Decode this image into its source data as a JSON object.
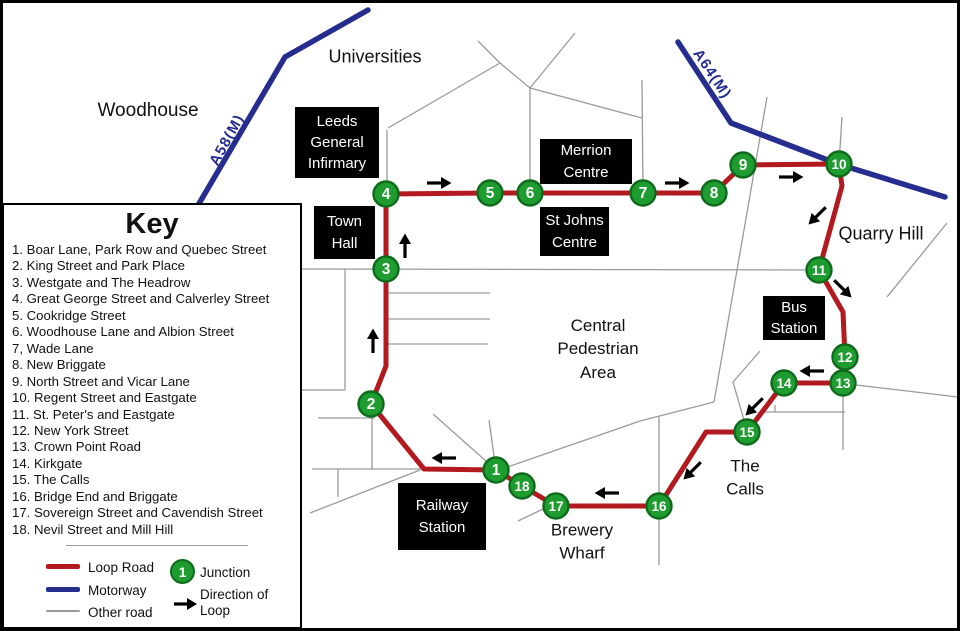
{
  "colors": {
    "loop_road": "#B21A20",
    "motorway": "#252D8F",
    "other_road": "#9A9A9A",
    "junction_fill": "#1E9C30",
    "junction_ring": "#0E6B1C",
    "junction_text": "#FFFFFF",
    "arrow": "#000000",
    "box_bg": "#000000",
    "box_text": "#FFFFFF"
  },
  "key_panel": {
    "title": "Key",
    "items": [
      "1. Boar Lane, Park Row and Quebec Street",
      "2. King Street and Park Place",
      "3. Westgate and The Headrow",
      "4. Great George Street and Calverley Street",
      "5. Cookridge Street",
      "6. Woodhouse Lane and Albion Street",
      "7, Wade Lane",
      "8. New Briggate",
      "9. North Street and Vicar Lane",
      "10. Regent Street and Eastgate",
      "11. St. Peter's and Eastgate",
      "12. New York Street",
      "13. Crown Point Road",
      "14. Kirkgate",
      "15. The Calls",
      "16. Bridge End and Briggate",
      "17. Sovereign Street and Cavendish Street",
      "18. Nevil Street and Mill Hill"
    ],
    "legend": {
      "loop_road_label": "Loop Road",
      "motorway_label": "Motorway",
      "other_road_label": "Other road",
      "junction_symbol": "1",
      "junction_label": "Junction",
      "direction_label": "Direction of Loop"
    }
  },
  "map": {
    "loop_road_path": "M386,194 L490,193 L530,193 L643,193 L714,193 L743,165 L839,164 L842,186 L819,270 L843,312 L845,357 L843,383 L784,383 L747,432 L706,432 L659,506 L556,506 L522,486 L496,470 L424,469 L371,404 L386,366 L386,269 Z",
    "motorways": [
      {
        "id": "a58m",
        "path": "M368,10 L285,57 L197,207"
      },
      {
        "id": "a64m",
        "path": "M678,42 L731,123 L838,164 L945,197"
      }
    ],
    "motorway_labels": [
      {
        "id": "a58m",
        "text": "A58(M)",
        "x": 227,
        "y": 140,
        "angle": -61
      },
      {
        "id": "a64m",
        "text": "A64(M)",
        "x": 712,
        "y": 74,
        "angle": 56
      }
    ],
    "other_roads": [
      "M478,41 L500,63 L530,88 L575,33",
      "M388,128 L500,63",
      "M387,130 L387,194",
      "M530,88 L530,193",
      "M530,88 L642,118",
      "M642,80 L643,193",
      "M767,97 L744,230 L714,402",
      "M842,117 L839,164",
      "M302,269 L819,270",
      "M387,293 L490,293",
      "M387,319 L490,319",
      "M387,344 L488,344",
      "M302,390 L345,390",
      "M345,269 L345,390",
      "M318,418 L375,418",
      "M372,404 L372,469",
      "M312,469 L424,469",
      "M338,469 L338,497",
      "M310,513 L420,470",
      "M496,471 L640,421 L714,402",
      "M760,351 L733,382 L744,420",
      "M659,417 L659,565",
      "M518,521 L545,508",
      "M496,470 L433,414",
      "M496,470 L489,420",
      "M762,412 L845,412",
      "M775,405 L775,412",
      "M843,385 L843,450",
      "M856,385 L958,397",
      "M887,297 L947,223"
    ],
    "junctions": [
      {
        "n": "1",
        "x": 496,
        "y": 470
      },
      {
        "n": "2",
        "x": 371,
        "y": 404
      },
      {
        "n": "3",
        "x": 386,
        "y": 269
      },
      {
        "n": "4",
        "x": 386,
        "y": 194
      },
      {
        "n": "5",
        "x": 490,
        "y": 193
      },
      {
        "n": "6",
        "x": 530,
        "y": 193
      },
      {
        "n": "7",
        "x": 643,
        "y": 193
      },
      {
        "n": "8",
        "x": 714,
        "y": 193
      },
      {
        "n": "9",
        "x": 743,
        "y": 165
      },
      {
        "n": "10",
        "x": 839,
        "y": 164
      },
      {
        "n": "11",
        "x": 819,
        "y": 270
      },
      {
        "n": "12",
        "x": 845,
        "y": 357
      },
      {
        "n": "13",
        "x": 843,
        "y": 383
      },
      {
        "n": "14",
        "x": 784,
        "y": 383
      },
      {
        "n": "15",
        "x": 747,
        "y": 432
      },
      {
        "n": "16",
        "x": 659,
        "y": 506
      },
      {
        "n": "17",
        "x": 556,
        "y": 506
      },
      {
        "n": "18",
        "x": 522,
        "y": 486
      }
    ],
    "direction_arrows": [
      {
        "x": 438,
        "y": 183,
        "angle": 0
      },
      {
        "x": 676,
        "y": 183,
        "angle": 0
      },
      {
        "x": 790,
        "y": 177,
        "angle": 0
      },
      {
        "x": 818,
        "y": 215,
        "angle": 135
      },
      {
        "x": 842,
        "y": 288,
        "angle": 45
      },
      {
        "x": 813,
        "y": 371,
        "angle": 180
      },
      {
        "x": 755,
        "y": 406,
        "angle": 135
      },
      {
        "x": 693,
        "y": 470,
        "angle": 135
      },
      {
        "x": 608,
        "y": 493,
        "angle": 180
      },
      {
        "x": 445,
        "y": 458,
        "angle": 180
      },
      {
        "x": 405,
        "y": 247,
        "angle": -90
      },
      {
        "x": 373,
        "y": 342,
        "angle": -90
      }
    ],
    "area_labels": [
      {
        "id": "woodhouse",
        "lines": [
          "Woodhouse"
        ],
        "x": 148,
        "y": 111,
        "size": 19
      },
      {
        "id": "universities",
        "lines": [
          "Universities"
        ],
        "x": 375,
        "y": 57,
        "size": 18
      },
      {
        "id": "quarry-hill",
        "lines": [
          "Quarry Hill"
        ],
        "x": 881,
        "y": 234,
        "size": 18
      },
      {
        "id": "central-pedestrian-area",
        "lines": [
          "Central",
          "Pedestrian",
          "Area"
        ],
        "x": 598,
        "y": 349,
        "size": 17
      },
      {
        "id": "the-calls",
        "lines": [
          "The",
          "Calls"
        ],
        "x": 745,
        "y": 478,
        "size": 17
      },
      {
        "id": "brewery-wharf",
        "lines": [
          "Brewery",
          "Wharf"
        ],
        "x": 582,
        "y": 542,
        "size": 17
      }
    ],
    "place_boxes": [
      {
        "id": "leeds-general-infirmary",
        "lines": [
          "Leeds",
          "General",
          "Infirmary"
        ],
        "x": 295,
        "y": 107,
        "w": 84,
        "h": 71
      },
      {
        "id": "town-hall",
        "lines": [
          "Town",
          "Hall"
        ],
        "x": 314,
        "y": 206,
        "w": 61,
        "h": 53
      },
      {
        "id": "merrion-centre",
        "lines": [
          "Merrion",
          "Centre"
        ],
        "x": 540,
        "y": 139,
        "w": 92,
        "h": 45
      },
      {
        "id": "st-johns-centre",
        "lines": [
          "St Johns",
          "Centre"
        ],
        "x": 540,
        "y": 207,
        "w": 69,
        "h": 49
      },
      {
        "id": "bus-station",
        "lines": [
          "Bus",
          "Station"
        ],
        "x": 763,
        "y": 296,
        "w": 62,
        "h": 44
      },
      {
        "id": "railway-station",
        "lines": [
          "Railway",
          "Station"
        ],
        "x": 398,
        "y": 483,
        "w": 88,
        "h": 67
      }
    ]
  }
}
